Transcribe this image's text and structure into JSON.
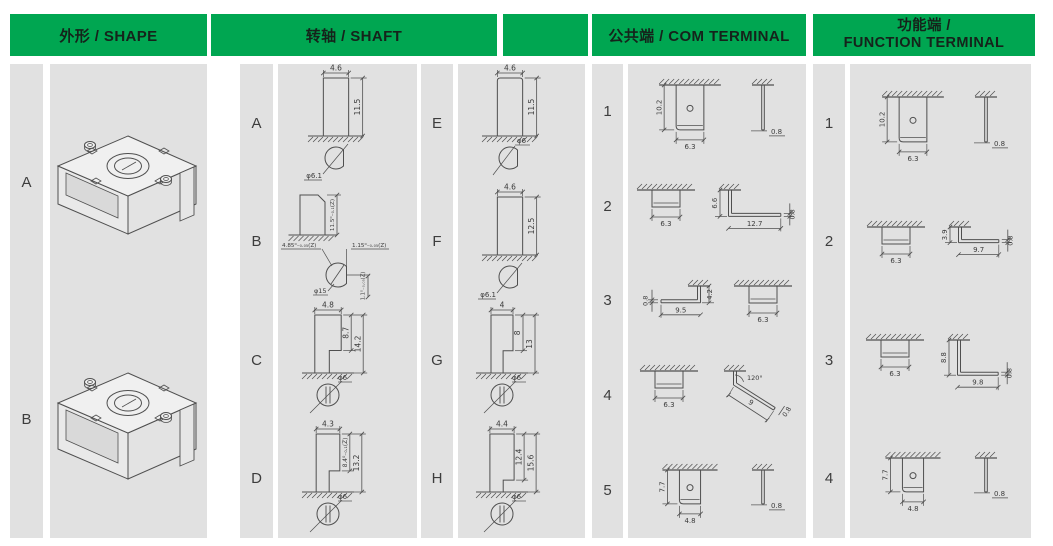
{
  "colors": {
    "header_green": "#00A651",
    "panel_gray": "#E1E1E1",
    "line_color": "#4F4F4F"
  },
  "headers": {
    "shape": "外形 / SHAPE",
    "shaft": "转轴 / SHAFT",
    "com": "公共端 / COM TERMINAL",
    "function_zh": "功能端 /",
    "function_en": "FUNCTION TERMINAL"
  },
  "shape_column": {
    "rows": [
      {
        "label": "A",
        "drawings": [
          {
            "kind": "iso",
            "variant": "A",
            "name": "housing-A-isometric-drawing"
          }
        ]
      },
      {
        "label": "B",
        "drawings": [
          {
            "kind": "iso",
            "variant": "B",
            "name": "housing-B-isometric-drawing"
          }
        ]
      }
    ]
  },
  "shaft_left": {
    "rows": [
      {
        "label": "A",
        "drawings": [
          {
            "kind": "dshaft",
            "name": "shaft-A-drawing",
            "top": "flat",
            "w": 4.6,
            "h": 11.5,
            "wLabel": "4.6",
            "hLabel": "11.5",
            "sec": "dflat",
            "secLabel": "φ6.1",
            "secPos": "bl"
          }
        ]
      },
      {
        "label": "B",
        "drawings": [
          {
            "kind": "bshaft",
            "name": "shaft-B-drawing",
            "hLabel": "11.5⁰₋₀.₁(Z)",
            "leftLabel": "4.85⁰₋₀.₀₅(Z)",
            "rightLabel": "1.15⁰₋₀.₀₅(Z)",
            "diaLabel": "φ15",
            "depthLabel": "1.1⁰₋₀.₀₅(Z)"
          }
        ]
      },
      {
        "label": "C",
        "drawings": [
          {
            "kind": "stepshaft",
            "name": "shaft-C-drawing",
            "w": 4.8,
            "inner": 8.7,
            "total": 14.2,
            "wLabel": "4.8",
            "innerLabel": "8.7",
            "totalLabel": "14.2",
            "secLabel": "φ6"
          }
        ]
      },
      {
        "label": "D",
        "drawings": [
          {
            "kind": "stepshaft",
            "name": "shaft-D-drawing",
            "w": 4.3,
            "inner": 8.4,
            "total": 13.2,
            "wLabel": "4.3",
            "innerLabel": "8.4⁰₋₀.₁(Z)",
            "totalLabel": "13.2",
            "secLabel": "φ6"
          }
        ]
      }
    ]
  },
  "shaft_right": {
    "rows": [
      {
        "label": "E",
        "drawings": [
          {
            "kind": "dshaft",
            "name": "shaft-E-drawing",
            "top": "round",
            "w": 4.6,
            "h": 11.5,
            "wLabel": "4.6",
            "hLabel": "11.5",
            "sec": "dflat",
            "secLabel": "φ6",
            "secPos": "top"
          }
        ]
      },
      {
        "label": "F",
        "drawings": [
          {
            "kind": "dshaft",
            "name": "shaft-F-drawing",
            "top": "flat",
            "w": 4.6,
            "h": 12.5,
            "wLabel": "4.6",
            "hLabel": "12.5",
            "sec": "dflat",
            "secLabel": "φ6.1",
            "secPos": "bl"
          }
        ]
      },
      {
        "label": "G",
        "drawings": [
          {
            "kind": "stepshaft",
            "name": "shaft-G-drawing",
            "w": 4,
            "inner": 8,
            "total": 13,
            "wLabel": "4",
            "innerLabel": "8",
            "totalLabel": "13",
            "secLabel": "φ6"
          }
        ]
      },
      {
        "label": "H",
        "drawings": [
          {
            "kind": "stepshaft",
            "name": "shaft-H-drawing",
            "w": 4.4,
            "inner": 12.4,
            "total": 15.6,
            "wLabel": "4.4",
            "innerLabel": "12.4",
            "totalLabel": "15.6",
            "secLabel": "φ6"
          }
        ]
      }
    ]
  },
  "com_column": {
    "rows": [
      {
        "label": "1",
        "drawings": [
          {
            "kind": "plate",
            "name": "com-terminal-1-front-view",
            "w": 6.3,
            "h": 10.2,
            "hole": true,
            "wLabel": "6.3",
            "hLabel": "10.2"
          },
          {
            "kind": "thin",
            "name": "com-terminal-1-side-view",
            "len": 10.2,
            "label": "0.8"
          }
        ]
      },
      {
        "label": "2",
        "drawings": [
          {
            "kind": "shortplate",
            "name": "com-terminal-2-front-view",
            "wLabel": "6.3"
          },
          {
            "kind": "lbend",
            "name": "com-terminal-2-side-view",
            "dir": "right",
            "down": 6.6,
            "run": 12.7,
            "downLabel": "6.6",
            "runLabel": "12.7",
            "thickLabel": "0.8"
          }
        ]
      },
      {
        "label": "3",
        "drawings": [
          {
            "kind": "lbend",
            "name": "com-terminal-3-side-view",
            "dir": "left",
            "down": 4.2,
            "run": 9.5,
            "downLabel": "4.2",
            "runLabel": "9.5",
            "thickLabel": "0.8"
          },
          {
            "kind": "shortplate",
            "name": "com-terminal-3-front-view",
            "wLabel": "6.3"
          }
        ]
      },
      {
        "label": "4",
        "drawings": [
          {
            "kind": "shortplate",
            "name": "com-terminal-4-front-view",
            "wLabel": "6.3"
          },
          {
            "kind": "angled",
            "name": "com-terminal-4-side-view",
            "angleLabel": "120°",
            "lenLabel": "9",
            "thickLabel": "0.8"
          }
        ]
      },
      {
        "label": "5",
        "drawings": [
          {
            "kind": "plate",
            "name": "com-terminal-5-front-view",
            "w": 4.8,
            "h": 7.7,
            "hole": true,
            "wLabel": "4.8",
            "hLabel": "7.7"
          },
          {
            "kind": "thin",
            "name": "com-terminal-5-side-view",
            "len": 7.7,
            "label": "0.8"
          }
        ]
      }
    ]
  },
  "function_column": {
    "rows": [
      {
        "label": "1",
        "drawings": [
          {
            "kind": "plate",
            "name": "function-terminal-1-front-view",
            "w": 6.3,
            "h": 10.2,
            "hole": true,
            "wLabel": "6.3",
            "hLabel": "10.2"
          },
          {
            "kind": "thin",
            "name": "function-terminal-1-side-view",
            "len": 10.2,
            "label": "0.8"
          }
        ]
      },
      {
        "label": "2",
        "drawings": [
          {
            "kind": "shortplate",
            "name": "function-terminal-2-front-view",
            "wLabel": "6.3"
          },
          {
            "kind": "lbend",
            "name": "function-terminal-2-side-view",
            "dir": "right",
            "down": 3.9,
            "run": 9.7,
            "downLabel": "3.9",
            "runLabel": "9.7",
            "thickLabel": "0.8"
          }
        ]
      },
      {
        "label": "3",
        "drawings": [
          {
            "kind": "shortplate",
            "name": "function-terminal-3-front-view",
            "wLabel": "6.3"
          },
          {
            "kind": "lbend",
            "name": "function-terminal-3-side-view",
            "dir": "right",
            "down": 8.8,
            "run": 9.8,
            "downLabel": "8.8",
            "runLabel": "9.8",
            "thickLabel": "0.8"
          }
        ]
      },
      {
        "label": "4",
        "drawings": [
          {
            "kind": "plate",
            "name": "function-terminal-4-front-view",
            "w": 4.8,
            "h": 7.7,
            "hole": true,
            "wLabel": "4.8",
            "hLabel": "7.7"
          },
          {
            "kind": "thin",
            "name": "function-terminal-4-side-view",
            "len": 7.7,
            "label": "0.8"
          }
        ]
      }
    ]
  }
}
